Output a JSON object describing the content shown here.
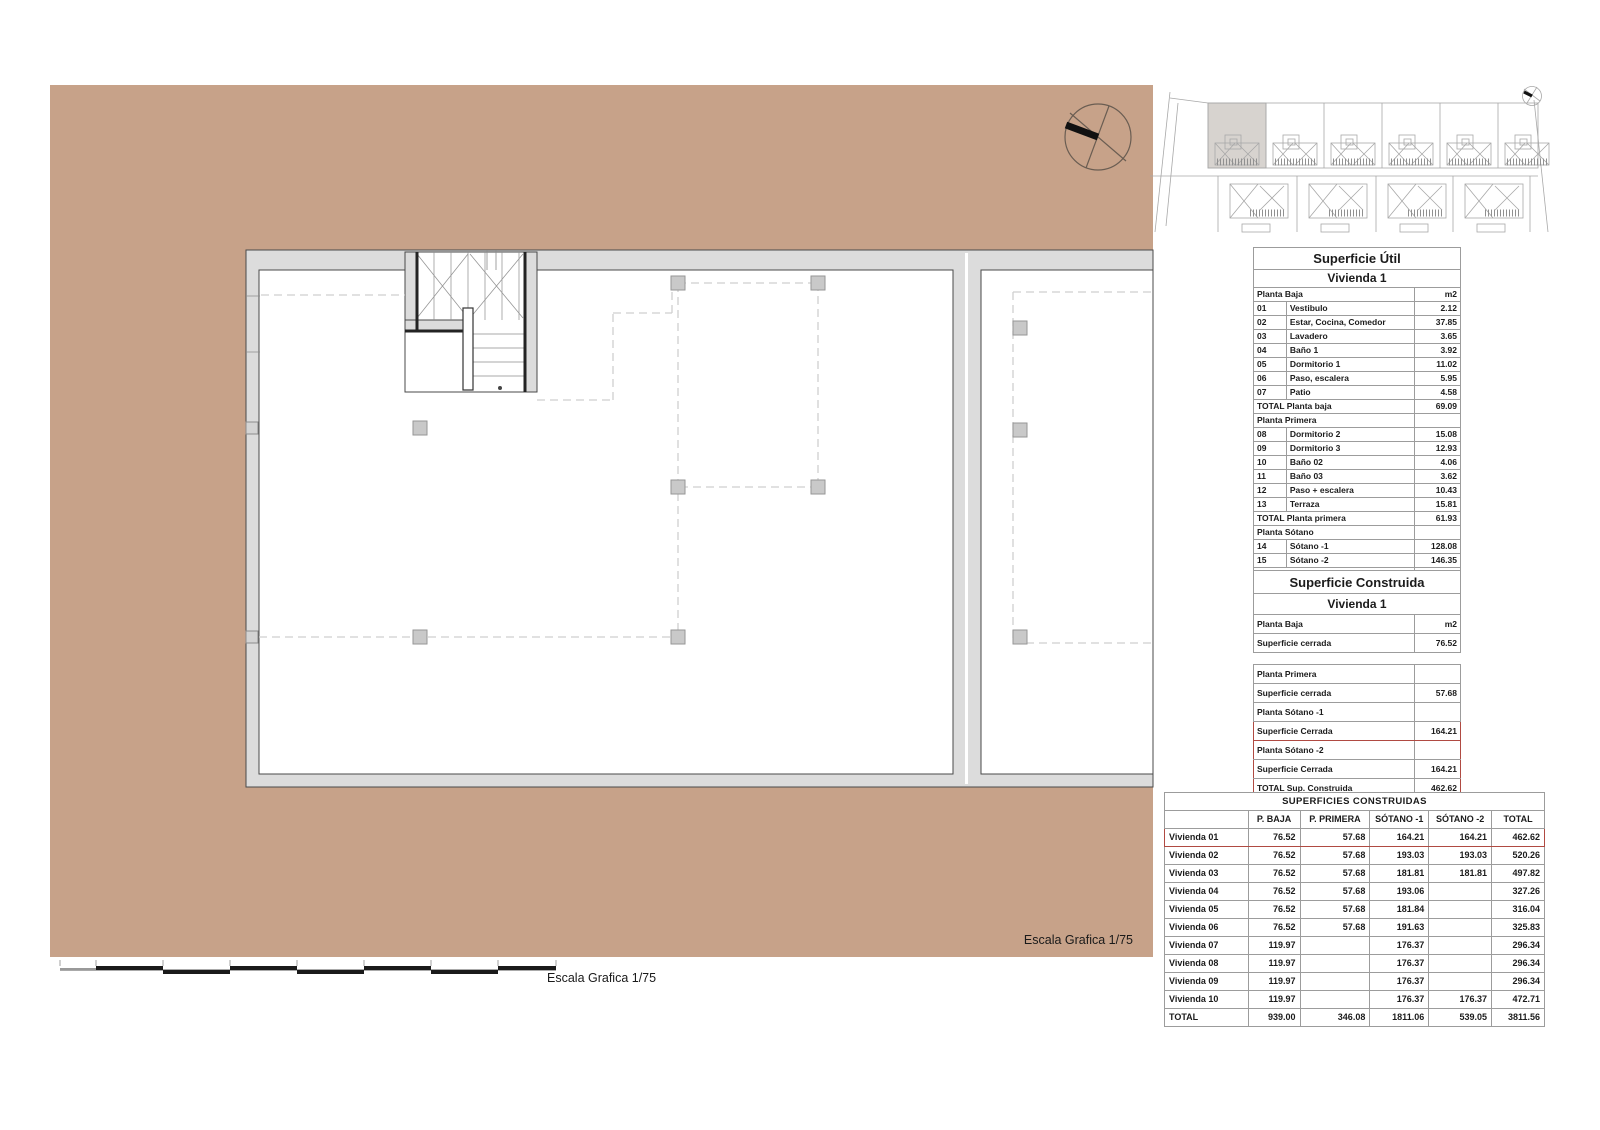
{
  "colors": {
    "background_tan": "#C7A289",
    "highlight_red": "#B04A42",
    "wall_gray": "#DCDCDC",
    "line_dark": "#4A4A4A"
  },
  "labels": {
    "escala_inner": "Escala Grafica 1/75",
    "escala_bottom": "Escala Grafica 1/75"
  },
  "tables": {
    "superficie_util": {
      "rows": [
        {
          "cls": "t1",
          "cells": [
            {
              "t": "Superficie Útil",
              "span": 3
            }
          ]
        },
        {
          "cls": "t2",
          "cells": [
            {
              "t": "Vivienda 1",
              "span": 3
            }
          ]
        },
        {
          "cells": [
            {
              "t": "Planta Baja",
              "span": 2
            },
            {
              "t": "m2",
              "cls": "num"
            }
          ]
        },
        {
          "cells": [
            {
              "t": "01"
            },
            {
              "t": "Vestibulo"
            },
            {
              "t": "2.12",
              "cls": "num"
            }
          ]
        },
        {
          "cells": [
            {
              "t": "02"
            },
            {
              "t": "Estar, Cocina, Comedor"
            },
            {
              "t": "37.85",
              "cls": "num"
            }
          ]
        },
        {
          "cells": [
            {
              "t": "03"
            },
            {
              "t": "Lavadero"
            },
            {
              "t": "3.65",
              "cls": "num"
            }
          ]
        },
        {
          "cells": [
            {
              "t": "04"
            },
            {
              "t": "Baño 1"
            },
            {
              "t": "3.92",
              "cls": "num"
            }
          ]
        },
        {
          "cells": [
            {
              "t": "05"
            },
            {
              "t": "Dormitorio 1"
            },
            {
              "t": "11.02",
              "cls": "num"
            }
          ]
        },
        {
          "cells": [
            {
              "t": "06"
            },
            {
              "t": "Paso, escalera"
            },
            {
              "t": "5.95",
              "cls": "num"
            }
          ]
        },
        {
          "cells": [
            {
              "t": "07"
            },
            {
              "t": "Patio"
            },
            {
              "t": "4.58",
              "cls": "num"
            }
          ]
        },
        {
          "cells": [
            {
              "t": "TOTAL Planta baja",
              "span": 2
            },
            {
              "t": "69.09",
              "cls": "num"
            }
          ]
        },
        {
          "cells": [
            {
              "t": "Planta Primera",
              "span": 2
            },
            {
              "t": "",
              "cls": "num"
            }
          ]
        },
        {
          "cells": [
            {
              "t": "08"
            },
            {
              "t": "Dormitorio 2"
            },
            {
              "t": "15.08",
              "cls": "num"
            }
          ]
        },
        {
          "cells": [
            {
              "t": "09"
            },
            {
              "t": "Dormitorio 3"
            },
            {
              "t": "12.93",
              "cls": "num"
            }
          ]
        },
        {
          "cells": [
            {
              "t": "10"
            },
            {
              "t": "Baño 02"
            },
            {
              "t": "4.06",
              "cls": "num"
            }
          ]
        },
        {
          "cells": [
            {
              "t": "11"
            },
            {
              "t": "Baño 03"
            },
            {
              "t": "3.62",
              "cls": "num"
            }
          ]
        },
        {
          "cells": [
            {
              "t": "12"
            },
            {
              "t": "Paso + escalera"
            },
            {
              "t": "10.43",
              "cls": "num"
            }
          ]
        },
        {
          "cells": [
            {
              "t": "13"
            },
            {
              "t": "Terraza"
            },
            {
              "t": "15.81",
              "cls": "num"
            }
          ]
        },
        {
          "cells": [
            {
              "t": "TOTAL Planta primera",
              "span": 2
            },
            {
              "t": "61.93",
              "cls": "num"
            }
          ]
        },
        {
          "cells": [
            {
              "t": "Planta Sótano",
              "span": 2
            },
            {
              "t": "",
              "cls": "num"
            }
          ]
        },
        {
          "cells": [
            {
              "t": "14"
            },
            {
              "t": "Sótano -1"
            },
            {
              "t": "128.08",
              "cls": "num"
            }
          ]
        },
        {
          "cells": [
            {
              "t": "15"
            },
            {
              "t": "Sótano -2"
            },
            {
              "t": "146.35",
              "cls": "num"
            }
          ]
        },
        {
          "cells": [
            {
              "t": "TOTAL",
              "span": 2
            },
            {
              "t": "405.45",
              "cls": "num"
            }
          ]
        }
      ]
    },
    "superficie_construida": {
      "rows": [
        {
          "cls": "t1",
          "cells": [
            {
              "t": "Superficie Construida",
              "span": 2
            }
          ]
        },
        {
          "cls": "t2",
          "cells": [
            {
              "t": "Vivienda 1",
              "span": 2
            }
          ]
        },
        {
          "cells": [
            {
              "t": "Planta Baja"
            },
            {
              "t": "m2",
              "cls": "num"
            }
          ]
        },
        {
          "cells": [
            {
              "t": "Superficie cerrada"
            },
            {
              "t": "76.52",
              "cls": "num"
            }
          ]
        },
        {
          "cls": "gap",
          "cells": [
            {
              "t": "",
              "span": 2
            }
          ]
        },
        {
          "cells": [
            {
              "t": "Planta Primera"
            },
            {
              "t": "",
              "cls": "num"
            }
          ]
        },
        {
          "cells": [
            {
              "t": "Superficie cerrada"
            },
            {
              "t": "57.68",
              "cls": "num"
            }
          ]
        },
        {
          "cells": [
            {
              "t": "Planta Sótano -1"
            },
            {
              "t": "",
              "cls": "num"
            }
          ]
        },
        {
          "cls": "red-top red-bot red-side",
          "cells": [
            {
              "t": "Superficie Cerrada"
            },
            {
              "t": "164.21",
              "cls": "num"
            }
          ]
        },
        {
          "cls": "red-top red-side",
          "cells": [
            {
              "t": "Planta Sótano -2"
            },
            {
              "t": "",
              "cls": "num"
            }
          ]
        },
        {
          "cls": "red-side",
          "cells": [
            {
              "t": "Superficie Cerrada"
            },
            {
              "t": "164.21",
              "cls": "num"
            }
          ]
        },
        {
          "cls": "red-bot red-side",
          "cells": [
            {
              "t": "TOTAL Sup. Construida"
            },
            {
              "t": "462.62",
              "cls": "num"
            }
          ]
        }
      ]
    },
    "superficies_construidas": {
      "rows": [
        {
          "cls": "t1",
          "cells": [
            {
              "t": "SUPERFICIES CONSTRUIDAS",
              "span": 6
            }
          ]
        },
        {
          "cls": "head",
          "cells": [
            {
              "t": ""
            },
            {
              "t": "P. BAJA"
            },
            {
              "t": "P. PRIMERA"
            },
            {
              "t": "SÓTANO -1"
            },
            {
              "t": "SÓTANO -2"
            },
            {
              "t": "TOTAL"
            }
          ]
        },
        {
          "cls": "red-top red-bot red-side",
          "cells": [
            {
              "t": "Vivienda 01"
            },
            {
              "t": "76.52",
              "cls": "num"
            },
            {
              "t": "57.68",
              "cls": "num"
            },
            {
              "t": "164.21",
              "cls": "num"
            },
            {
              "t": "164.21",
              "cls": "num"
            },
            {
              "t": "462.62",
              "cls": "num"
            }
          ]
        },
        {
          "cells": [
            {
              "t": "Vivienda 02"
            },
            {
              "t": "76.52",
              "cls": "num"
            },
            {
              "t": "57.68",
              "cls": "num"
            },
            {
              "t": "193.03",
              "cls": "num"
            },
            {
              "t": "193.03",
              "cls": "num"
            },
            {
              "t": "520.26",
              "cls": "num"
            }
          ]
        },
        {
          "cells": [
            {
              "t": "Vivienda 03"
            },
            {
              "t": "76.52",
              "cls": "num"
            },
            {
              "t": "57.68",
              "cls": "num"
            },
            {
              "t": "181.81",
              "cls": "num"
            },
            {
              "t": "181.81",
              "cls": "num"
            },
            {
              "t": "497.82",
              "cls": "num"
            }
          ]
        },
        {
          "cells": [
            {
              "t": "Vivienda 04"
            },
            {
              "t": "76.52",
              "cls": "num"
            },
            {
              "t": "57.68",
              "cls": "num"
            },
            {
              "t": "193.06",
              "cls": "num"
            },
            {
              "t": "",
              "cls": "num"
            },
            {
              "t": "327.26",
              "cls": "num"
            }
          ]
        },
        {
          "cells": [
            {
              "t": "Vivienda 05"
            },
            {
              "t": "76.52",
              "cls": "num"
            },
            {
              "t": "57.68",
              "cls": "num"
            },
            {
              "t": "181.84",
              "cls": "num"
            },
            {
              "t": "",
              "cls": "num"
            },
            {
              "t": "316.04",
              "cls": "num"
            }
          ]
        },
        {
          "cells": [
            {
              "t": "Vivienda 06"
            },
            {
              "t": "76.52",
              "cls": "num"
            },
            {
              "t": "57.68",
              "cls": "num"
            },
            {
              "t": "191.63",
              "cls": "num"
            },
            {
              "t": "",
              "cls": "num"
            },
            {
              "t": "325.83",
              "cls": "num"
            }
          ]
        },
        {
          "cells": [
            {
              "t": "Vivienda 07"
            },
            {
              "t": "119.97",
              "cls": "num"
            },
            {
              "t": "",
              "cls": "num"
            },
            {
              "t": "176.37",
              "cls": "num"
            },
            {
              "t": "",
              "cls": "num"
            },
            {
              "t": "296.34",
              "cls": "num"
            }
          ]
        },
        {
          "cells": [
            {
              "t": "Vivienda 08"
            },
            {
              "t": "119.97",
              "cls": "num"
            },
            {
              "t": "",
              "cls": "num"
            },
            {
              "t": "176.37",
              "cls": "num"
            },
            {
              "t": "",
              "cls": "num"
            },
            {
              "t": "296.34",
              "cls": "num"
            }
          ]
        },
        {
          "cells": [
            {
              "t": "Vivienda 09"
            },
            {
              "t": "119.97",
              "cls": "num"
            },
            {
              "t": "",
              "cls": "num"
            },
            {
              "t": "176.37",
              "cls": "num"
            },
            {
              "t": "",
              "cls": "num"
            },
            {
              "t": "296.34",
              "cls": "num"
            }
          ]
        },
        {
          "cells": [
            {
              "t": "Vivienda 10"
            },
            {
              "t": "119.97",
              "cls": "num"
            },
            {
              "t": "",
              "cls": "num"
            },
            {
              "t": "176.37",
              "cls": "num"
            },
            {
              "t": "176.37",
              "cls": "num"
            },
            {
              "t": "472.71",
              "cls": "num"
            }
          ]
        },
        {
          "cells": [
            {
              "t": "TOTAL"
            },
            {
              "t": "939.00",
              "cls": "num"
            },
            {
              "t": "346.08",
              "cls": "num"
            },
            {
              "t": "1811.06",
              "cls": "num"
            },
            {
              "t": "539.05",
              "cls": "num"
            },
            {
              "t": "3811.56",
              "cls": "num"
            }
          ]
        }
      ]
    }
  }
}
